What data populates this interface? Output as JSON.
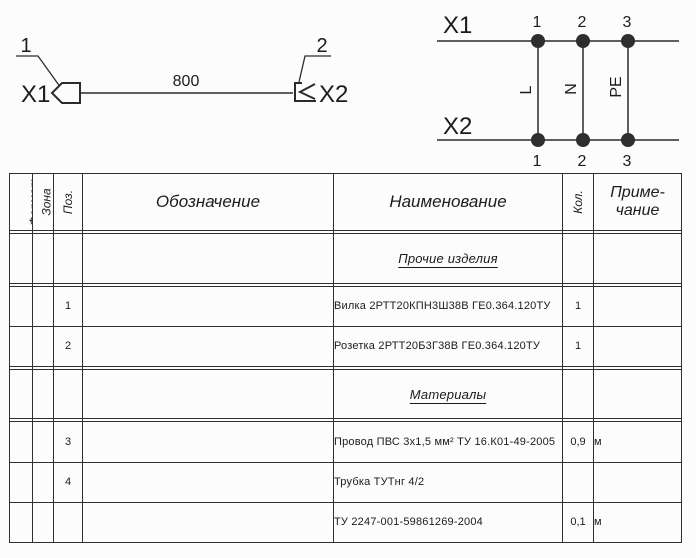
{
  "colors": {
    "line": "#2b2b2b",
    "text": "#1c1c1c",
    "background": "#fcfcfc"
  },
  "cable_drawing": {
    "callout1": "1",
    "callout2": "2",
    "x1_label": "X1",
    "x2_label": "X2",
    "length_label": "800"
  },
  "wiring_diagram": {
    "x1_label": "X1",
    "x2_label": "X2",
    "top_pins": [
      "1",
      "2",
      "3"
    ],
    "bottom_pins": [
      "1",
      "2",
      "3"
    ],
    "wires": [
      "L",
      "N",
      "PE"
    ]
  },
  "spec_table": {
    "headers": {
      "format": "Формат",
      "zone": "Зона",
      "pos": "Поз.",
      "designation": "Обозначение",
      "name": "Наименование",
      "qty": "Кол.",
      "note": "Приме-\nчание"
    },
    "rows": [
      {
        "pos": "",
        "designation": "",
        "name": "",
        "qty": "",
        "note": ""
      },
      {
        "pos": "",
        "designation": "",
        "name": "Прочие изделия",
        "qty": "",
        "note": ""
      },
      {
        "pos": "",
        "designation": "",
        "name": "",
        "qty": "",
        "note": ""
      },
      {
        "pos": "1",
        "designation": "",
        "name": "Вилка 2РТТ20КПН3Ш38В ГЕ0.364.120ТУ",
        "qty": "1",
        "note": ""
      },
      {
        "pos": "2",
        "designation": "",
        "name": "Розетка 2РТТ20Б3Г38В ГЕ0.364.120ТУ",
        "qty": "1",
        "note": ""
      },
      {
        "pos": "",
        "designation": "",
        "name": "",
        "qty": "",
        "note": ""
      },
      {
        "pos": "",
        "designation": "",
        "name": "Материалы",
        "qty": "",
        "note": ""
      },
      {
        "pos": "",
        "designation": "",
        "name": "",
        "qty": "",
        "note": ""
      },
      {
        "pos": "3",
        "designation": "",
        "name": "Провод ПВС 3х1,5 мм² ТУ 16.К01-49-2005",
        "qty": "0,9",
        "note": "м"
      },
      {
        "pos": "4",
        "designation": "",
        "name": "Трубка ТУТнг 4/2",
        "qty": "",
        "note": ""
      },
      {
        "pos": "",
        "designation": "",
        "name": "ТУ 2247-001-59861269-2004",
        "qty": "0,1",
        "note": "м"
      }
    ]
  }
}
